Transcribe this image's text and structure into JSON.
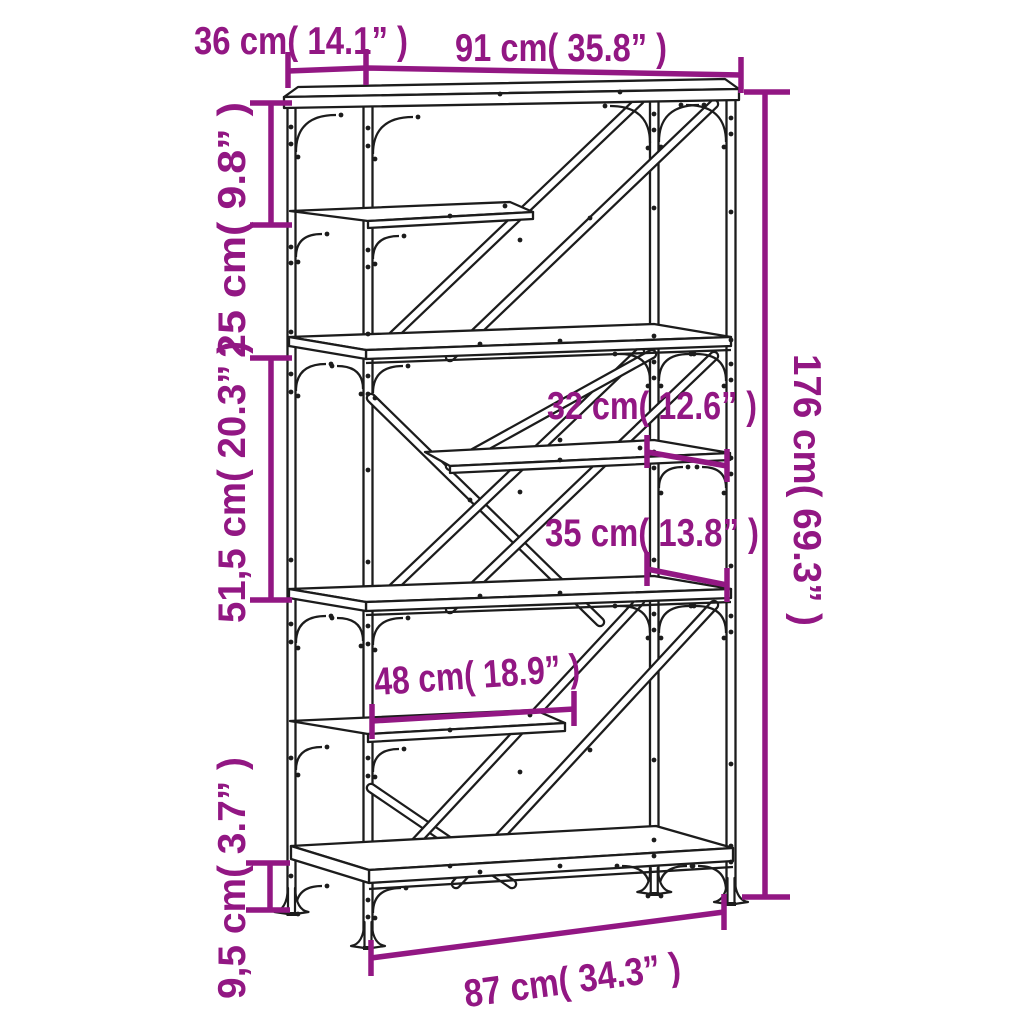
{
  "diagram": {
    "subject": "bookshelf-dimension-diagram",
    "colors": {
      "dimension_accent": "#921783",
      "drawing_outline": "#1c1c1c",
      "background": "#ffffff"
    },
    "dims": {
      "depth_top": "36 cm( 14.1” )",
      "width_top": "91 cm( 35.8” )",
      "top_section_height": "25 cm( 9.8” )",
      "middle_section_height": "51,5 cm( 20.3” )",
      "total_height": "176 cm( 69.3” )",
      "shelf_depth_upper": "32 cm( 12.6” )",
      "shelf_depth_lower": "35 cm( 13.8” )",
      "half_shelf_width": "48 cm( 18.9” )",
      "foot_height": "9,5 cm( 3.7” )",
      "width_bottom": "87 cm( 34.3” )"
    }
  }
}
